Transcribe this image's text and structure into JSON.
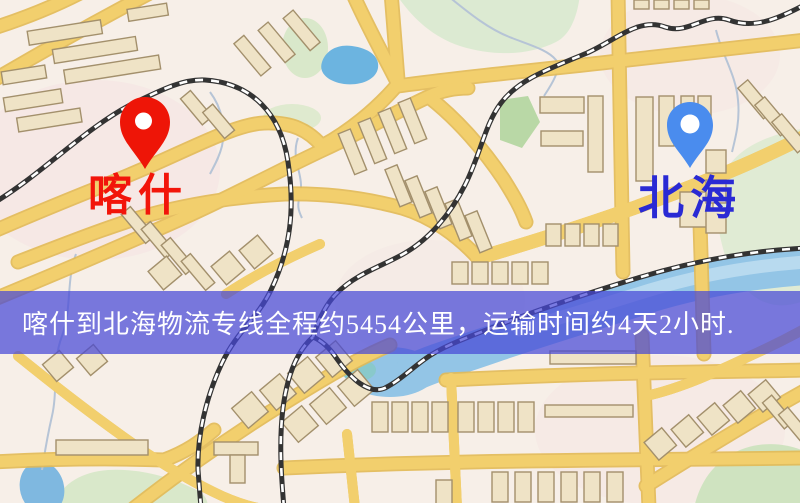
{
  "map": {
    "title": "喀什到北海物流专线地图",
    "origin": {
      "name": "喀什",
      "pin_color": "#ee1507",
      "label_color": "#f2150a"
    },
    "destination": {
      "name": "北海",
      "pin_color": "#4a8cee",
      "label_color": "#2a2ad4"
    },
    "banner": {
      "text": "喀什到北海物流专线全程约5454公里，运输时间约4天2小时.",
      "distance_km": "5454",
      "duration": "4天2小时",
      "bg_color": "rgba(70,72,215,0.72)",
      "text_color": "#ffffff"
    },
    "palette": {
      "base": "#f7efe8",
      "road": "#f2cf6d",
      "road_casing": "#e3ba55",
      "building_fill": "#efe3c6",
      "building_outline": "#a3906c",
      "green_area": "#dcead2",
      "water": "#93c5e6",
      "railway": "#333333"
    }
  }
}
